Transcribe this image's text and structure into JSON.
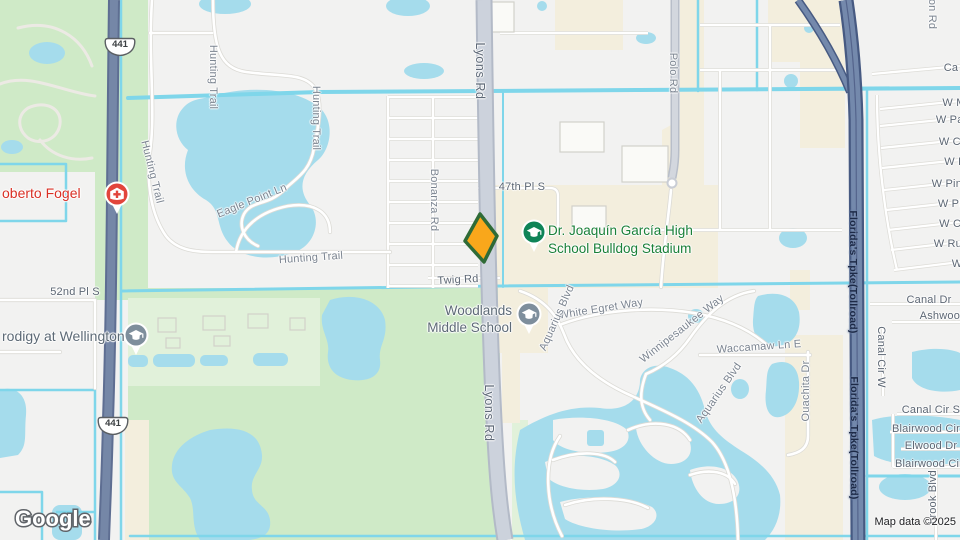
{
  "attribution": {
    "logo": "Google",
    "map_data": "Map data ©2025"
  },
  "shield": {
    "route": "441"
  },
  "colors": {
    "land": "#f2f2f1",
    "park": "#cfeac7",
    "park_light": "#e1f1da",
    "beige": "#f3eedd",
    "water": "#a5dcec",
    "canal": "#7fd6ea",
    "lyons_fill": "#ccd2dc",
    "lyons_casing": "#b3bac7",
    "highway_fill": "#7489ac",
    "highway_casing": "#475a82",
    "poi_green": "#1a8038",
    "poi_red": "#d93025",
    "poi_gray": "#5d6a76",
    "marker_fill": "#f9a71b",
    "marker_stroke": "#2f6b36"
  },
  "pois": {
    "selected": {
      "marker": "kite-marker"
    },
    "high_school": {
      "line1": "Dr. Joaquín García High",
      "line2": "School Bulldog Stadium"
    },
    "middle_school": {
      "line1": "Woodlands",
      "line2": "Middle School"
    },
    "hospital": {
      "label": "oberto Fogel"
    },
    "wellington": {
      "label": "rodigy at Wellington"
    }
  },
  "map_labels": [
    {
      "text": "Hunting Trail"
    },
    {
      "text": "Hunting Trail"
    },
    {
      "text": "Hunting Trail"
    },
    {
      "text": "Hunting Trail"
    },
    {
      "text": "Eagle Point Ln"
    },
    {
      "text": "52nd Pl S"
    },
    {
      "text": "Bonanza Rd"
    },
    {
      "text": "47th Pl S"
    },
    {
      "text": "Twig Rd"
    },
    {
      "text": "Lyons Rd"
    },
    {
      "text": "Lyons Rd"
    },
    {
      "text": "Polo Rd"
    },
    {
      "text": "on Rd"
    },
    {
      "text": "White Egret Way"
    },
    {
      "text": "Aquarius Blvd"
    },
    {
      "text": "Aquarius Blvd"
    },
    {
      "text": "Winnipesaukee Way"
    },
    {
      "text": "Waccamaw Ln E"
    },
    {
      "text": "Ouachita Dr"
    },
    {
      "text": "Canal Dr"
    },
    {
      "text": "Ashwood"
    },
    {
      "text": "Canal Cir W"
    },
    {
      "text": "Canal Cir S"
    },
    {
      "text": "Blairwood Cir"
    },
    {
      "text": "Elwood Dr"
    },
    {
      "text": "Blairwood Cir"
    },
    {
      "text": "brook Blvd"
    },
    {
      "text": "Ca"
    },
    {
      "text": "W M"
    },
    {
      "text": "W Pal"
    },
    {
      "text": "W Co"
    },
    {
      "text": "W P"
    },
    {
      "text": "W Pine"
    },
    {
      "text": "W Plu"
    },
    {
      "text": "W Cy"
    },
    {
      "text": "W Rub"
    },
    {
      "text": "W"
    },
    {
      "text": "Florida's Tpke(Tollroad)"
    },
    {
      "text": "Florida's Tpke(Tollroad)"
    }
  ]
}
